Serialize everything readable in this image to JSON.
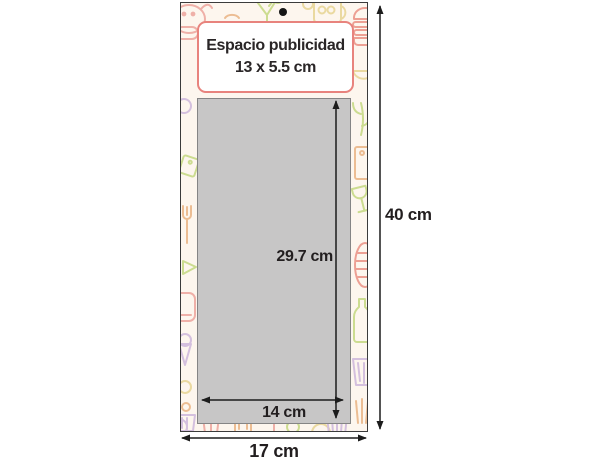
{
  "diagram": {
    "ad_space": {
      "line1": "Espacio publicidad",
      "line2": "13 x 5.5 cm"
    },
    "dimensions": {
      "pad_height": "29.7 cm",
      "pad_width": "14 cm",
      "total_width": "17 cm",
      "total_height": "40 cm"
    },
    "colors": {
      "card_background": "#fdf6ee",
      "pad_gray": "#c7c6c6",
      "ad_box_border": "#e8837d",
      "arrow_black": "#1c1c1c"
    }
  }
}
